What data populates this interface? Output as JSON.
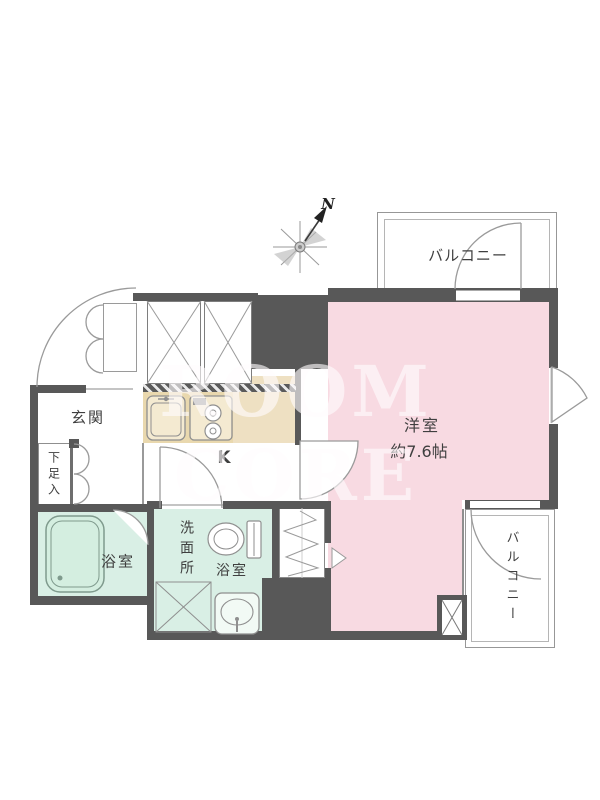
{
  "watermark": {
    "text": "ROOM CORE"
  },
  "compass": {
    "north_label": "N"
  },
  "rooms": {
    "balcony_top": {
      "label": "バルコニー"
    },
    "main_room": {
      "label": "洋室",
      "size": "約7.6帖"
    },
    "entrance": {
      "label": "玄関"
    },
    "shoe_cabinet": {
      "label": "下足入"
    },
    "kitchen": {
      "label": "K"
    },
    "bathroom": {
      "label": "浴室"
    },
    "washroom": {
      "label": "洗面所",
      "sub_label": "浴室"
    },
    "balcony_bottom": {
      "label": "バルコニー"
    }
  },
  "colors": {
    "wall": "#585858",
    "main_room_fill": "#f8dae2",
    "wet_area_fill": "#d9efe5",
    "kitchen_counter_fill": "#e9d8ae",
    "outline": "#999999"
  }
}
